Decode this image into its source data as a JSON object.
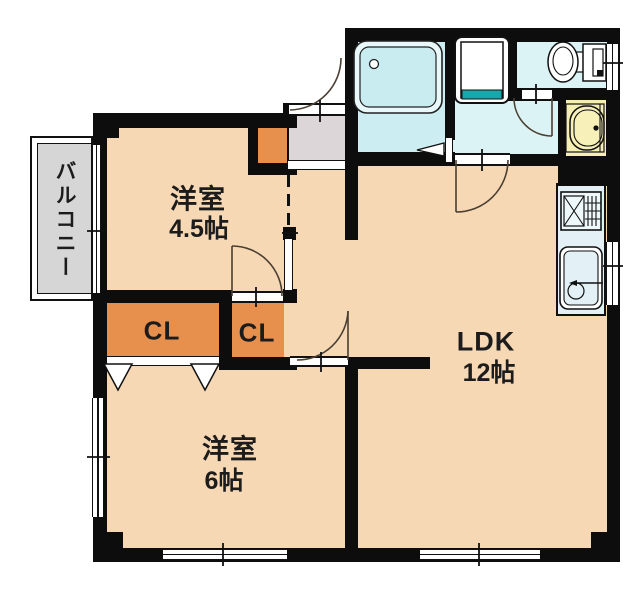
{
  "floorplan": {
    "title": "apartment-floor-plan",
    "balcony": {
      "label": "バルコニー"
    },
    "rooms": {
      "western_small": {
        "name": "洋室",
        "size": "4.5帖"
      },
      "western_large": {
        "name": "洋室",
        "size": "6帖"
      },
      "ldk": {
        "name": "LDK",
        "size": "12帖"
      }
    },
    "closets": {
      "left_label": "CL",
      "right_label": "CL"
    },
    "fixtures": [
      "bathtub",
      "washing-machine-pan",
      "toilet",
      "washbasin",
      "stove",
      "kitchen-sink"
    ],
    "colors": {
      "floor": "#f7d8b4",
      "closet_orange": "#e78f4c",
      "wet_area": "#dcf3f5",
      "bath": "#cceef2",
      "kitchen_counter": "#e3f0f6",
      "basin_yellow": "#f6efb4",
      "accent_teal": "#16a9ac",
      "genkan_gray": "#ddd6d9",
      "balcony_gray": "#d6d6d6",
      "wall": "#0d0d0d"
    }
  }
}
